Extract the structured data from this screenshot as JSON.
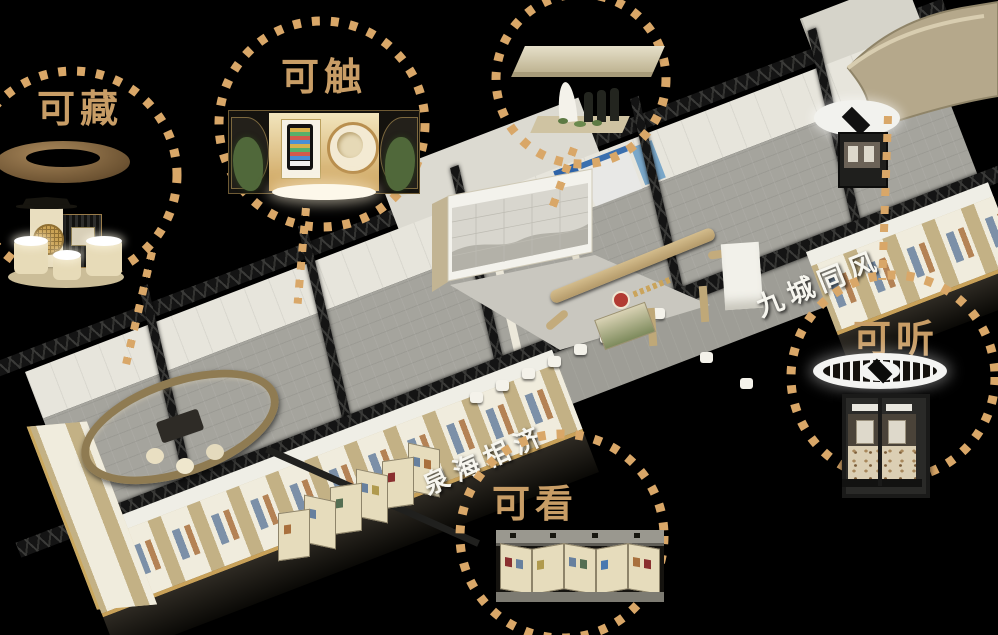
{
  "scene": {
    "background_color": "#000000",
    "label_color": "#c89d66",
    "dotted_ring_color": "#d9a768"
  },
  "callouts": {
    "collect": {
      "label": "可藏"
    },
    "touch": {
      "label": "可触"
    },
    "listen": {
      "label": "可听"
    },
    "view": {
      "label": "可看"
    }
  },
  "hall": {
    "left_wall_calligraphy": "泉海相济",
    "right_wall_calligraphy": "九城同风"
  }
}
